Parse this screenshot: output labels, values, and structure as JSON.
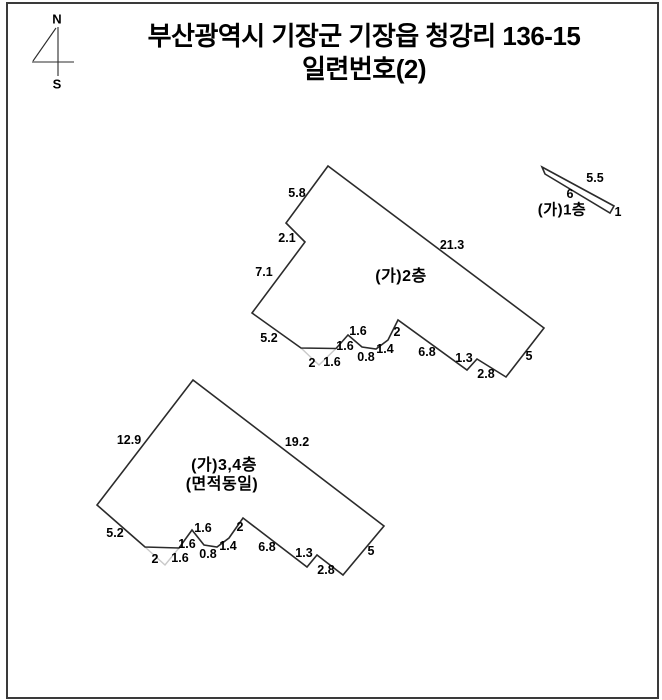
{
  "title": {
    "line1": "부산광역시 기장군 기장읍 청강리 136-15",
    "line2": "일련번호(2)"
  },
  "compass": {
    "north_label": "N",
    "south_label": "S"
  },
  "colors": {
    "outline": "#2b2b2b",
    "faint_line": "#c9c9c9",
    "text": "#000000",
    "frame": "#3a3a3a",
    "background": "#ffffff"
  },
  "floors": {
    "floor1": {
      "name": "(가)1층",
      "dims": {
        "upper": "5.5",
        "lower": "6",
        "right_end": "1"
      }
    },
    "floor2": {
      "name": "(가)2층",
      "dims": {
        "upper_left": "5.8",
        "left_jog": "2.1",
        "lower_left": "7.1",
        "upper_right": "21.3",
        "bottom_left": "5.2",
        "notch_left": "2",
        "notch_right": "1.6",
        "zig_rise_a": "1.6",
        "zig_fall_a": "1.6",
        "zig_flat": "0.8",
        "zig_rise_b": "1.4",
        "zig_rise_c": "2",
        "bottom_mid": "6.8",
        "step_up": "1.3",
        "step_down": "2.8",
        "right_end": "5"
      }
    },
    "floor34": {
      "name": "(가)3,4층",
      "note": "(면적동일)",
      "dims": {
        "upper_left": "12.9",
        "upper_right": "19.2",
        "bottom_left": "5.2",
        "notch_left": "2",
        "notch_right": "1.6",
        "zig_rise_a": "1.6",
        "zig_fall_a": "1.6",
        "zig_flat": "0.8",
        "zig_rise_b": "1.4",
        "zig_rise_c": "2",
        "bottom_mid": "6.8",
        "step_up": "1.3",
        "step_down": "2.8",
        "right_end": "5"
      }
    }
  }
}
